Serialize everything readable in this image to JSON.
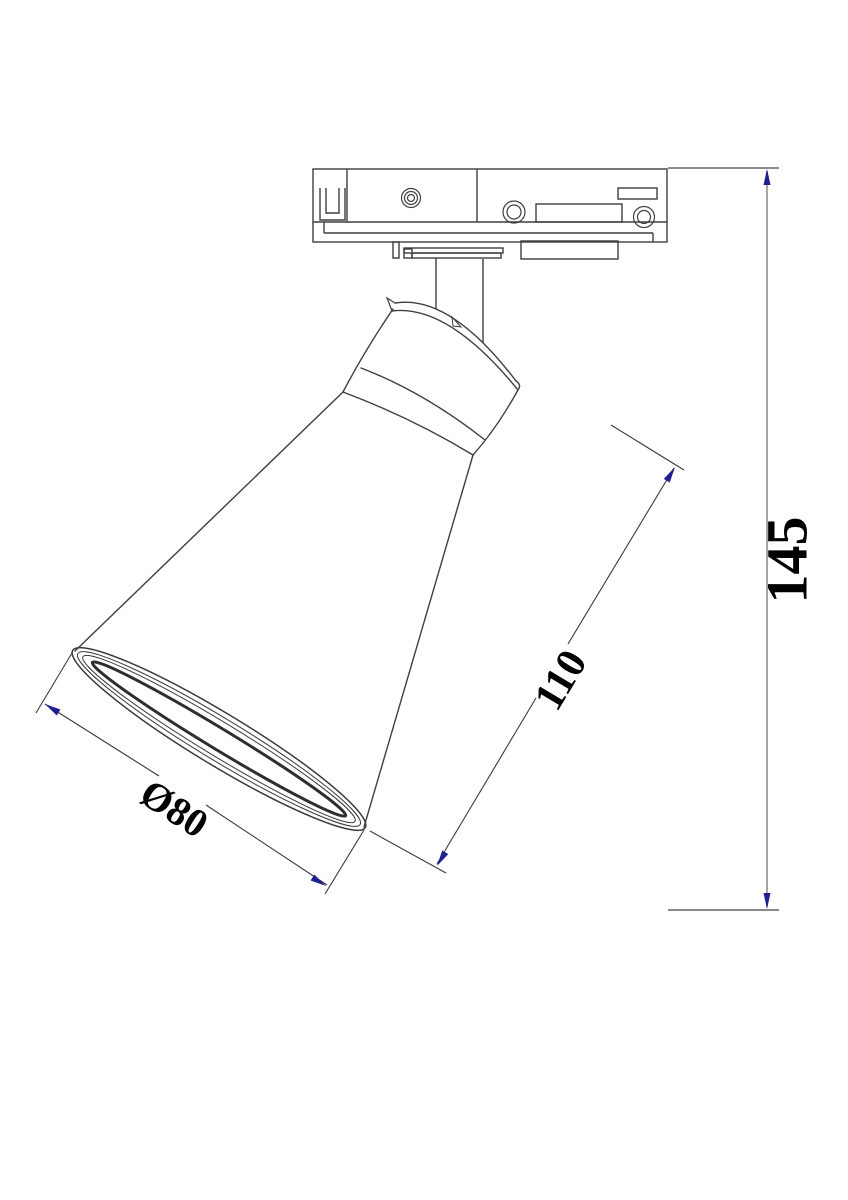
{
  "page": {
    "background": "#ffffff"
  },
  "drawing": {
    "subject": "track-spotlight-dimensional-drawing",
    "view": "side elevation",
    "colors": {
      "outline": "#3f3f3f",
      "dimension_line": "#3a3a3a",
      "height_dimension_line": "#8a8a8a",
      "arrow": "#1f1f8f",
      "label_text": "#000000"
    },
    "dimensions": {
      "height": {
        "label": "145",
        "orientation": "vertical-right"
      },
      "body_length": {
        "label": "110",
        "orientation": "aligned-with-lamp-axis"
      },
      "opening_diameter": {
        "label": "Ø80",
        "orientation": "aligned-with-shade-opening"
      }
    }
  }
}
